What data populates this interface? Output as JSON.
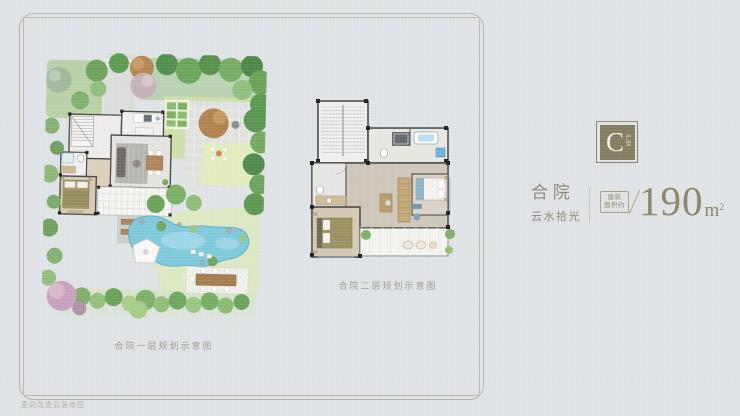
{
  "page": {
    "background": "#e0e4e7",
    "frame_color": "#b6b5ac"
  },
  "plans": [
    {
      "id": "first-floor",
      "caption": "合院一层规划示意图"
    },
    {
      "id": "second-floor",
      "caption": "合院二层规划示意图"
    }
  ],
  "info": {
    "badge": {
      "letter": "C",
      "sub": "户型",
      "bg": "#847c5f",
      "border": "#8a8264"
    },
    "title": "合 院",
    "subtitle": "云水拾光",
    "area_label_line1": "建筑",
    "area_label_line2": "面积约",
    "area_value": "190",
    "area_unit": "m",
    "area_unit_sup": "2",
    "accent_color": "#8c8366",
    "text_color": "#8b8576"
  },
  "watermark": {
    "text": "意向改造后装修图"
  },
  "illustration_colors": {
    "pool": "#7ecadd",
    "lawn": "#dde9c3",
    "tree_green": "#6aa257",
    "floor_gray": "#e6e4e0",
    "wood": "#d5c9b3",
    "wall": "#4a4a48"
  }
}
